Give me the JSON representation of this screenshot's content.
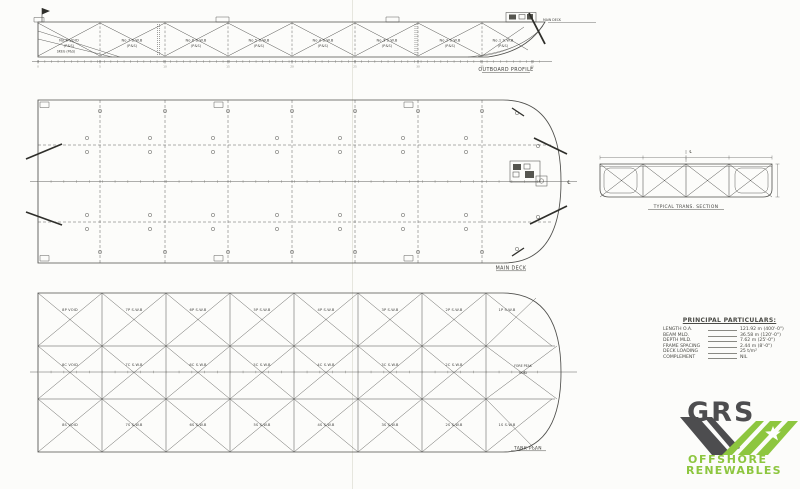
{
  "profile": {
    "caption": "OUTBOARD PROFILE",
    "main_deck_label": "MAIN DECK",
    "skeg_label": "SKEG (P&S)",
    "tanks": [
      {
        "name": "No.8 VOID",
        "sub": "(P&S)"
      },
      {
        "name": "No.7 S.W.B",
        "sub": "(P&S)"
      },
      {
        "name": "No.6 S.W.B",
        "sub": "(P&S)"
      },
      {
        "name": "No.5 S.W.B",
        "sub": "(P&S)"
      },
      {
        "name": "No.4 S.W.B",
        "sub": "(P&S)"
      },
      {
        "name": "No.3 S.W.B",
        "sub": "(P&S)"
      },
      {
        "name": "No.2 S.W.B",
        "sub": "(P&S)"
      },
      {
        "name": "No.1 S.W.B",
        "sub": "(P&S)"
      }
    ],
    "frame_numbers": [
      "0",
      "5",
      "10",
      "15",
      "20",
      "25",
      "30",
      "35",
      "40"
    ]
  },
  "main_deck": {
    "caption": "MAIN DECK",
    "centerline_symbol": "℄"
  },
  "trans_section": {
    "caption": "TYPICAL TRANS. SECTION",
    "centerline_symbol": "℄"
  },
  "tank_plan": {
    "caption": "TANK PLAN",
    "row_port": [
      "8P VOID",
      "7P S.W.B",
      "6P S.W.B",
      "5P S.W.B",
      "4P S.W.B",
      "3P S.W.B",
      "2P S.W.B",
      "1P S.W.B"
    ],
    "row_center": [
      "8C VOID",
      "7C S.W.B",
      "6C S.W.B",
      "5C S.W.B",
      "4C S.W.B",
      "3C S.W.B",
      "2C S.W.B"
    ],
    "row_stbd": [
      "8S VOID",
      "7S S.W.B",
      "6S S.W.B",
      "5S S.W.B",
      "4S S.W.B",
      "3S S.W.B",
      "2S S.W.B",
      "1S S.W.B"
    ],
    "fore_peak": {
      "line1": "FORE PEAK",
      "line2": "VOID"
    }
  },
  "particulars": {
    "title": "PRINCIPAL PARTICULARS:",
    "rows": [
      {
        "label": "LENGTH O.A.",
        "value": "121.92 m (400'-0\")"
      },
      {
        "label": "BEAM MLD.",
        "value": "36.58 m (120'-0\")"
      },
      {
        "label": "DEPTH MLD.",
        "value": "7.62 m (25'-0\")"
      },
      {
        "label": "FRAME SPACING",
        "value": "2.44 m (8'-0\")"
      },
      {
        "label": "DECK LOADING",
        "value": "25 t/m²"
      },
      {
        "label": "COMPLEMENT",
        "value": "NIL"
      }
    ]
  },
  "logo": {
    "name": "GRS",
    "line1": "OFFSHORE",
    "line2": "RENEWABLES",
    "green": "#8dc63f",
    "dark": "#4d4d4f"
  }
}
